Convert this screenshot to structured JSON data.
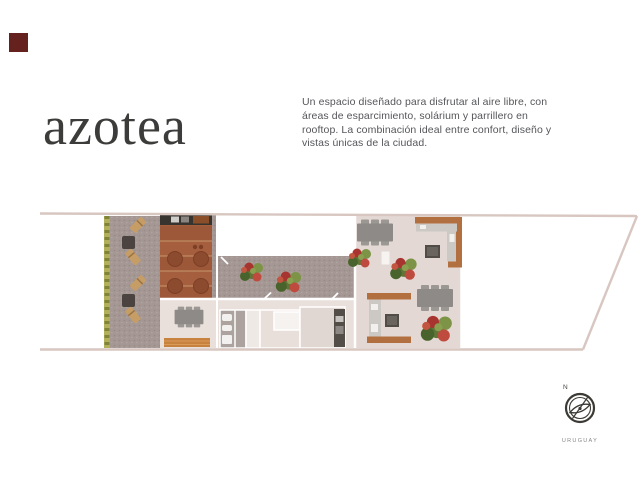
{
  "slide": {
    "background_color": "#ffffff"
  },
  "brand": {
    "logo_square_color": "#64211e"
  },
  "header": {
    "title": "azotea",
    "title_color": "#3c3c3a",
    "description_color": "#55565a",
    "description_lines": [
      "Un espacio diseñado para disfrutar al aire libre, con",
      "áreas de esparcimiento, solárium y parrillero en",
      "rooftop. La combinación ideal entre confort, diseño y",
      "vistas únicas de la ciudad."
    ]
  },
  "floorplan": {
    "type": "rooftop top-view architectural render",
    "outline_color": "#d8c7c1",
    "floor_color": "#e4d8d4",
    "gravel_color": "#a59894",
    "deck_color": "#a55f3e",
    "planter_color": "#b2b05a",
    "wood_counter_color": "#b26f3f",
    "areas": [
      "gravel terrace with sun loungers",
      "green planter strip",
      "wood solarium deck with round tubs",
      "interior rooms: dining, bathroom, kitchen",
      "terrace with plants",
      "parrillero counters",
      "dining tables",
      "open lot area"
    ]
  },
  "compass": {
    "north_label": "N",
    "country_label": "URUGUAY",
    "color": "#3c3a34"
  }
}
